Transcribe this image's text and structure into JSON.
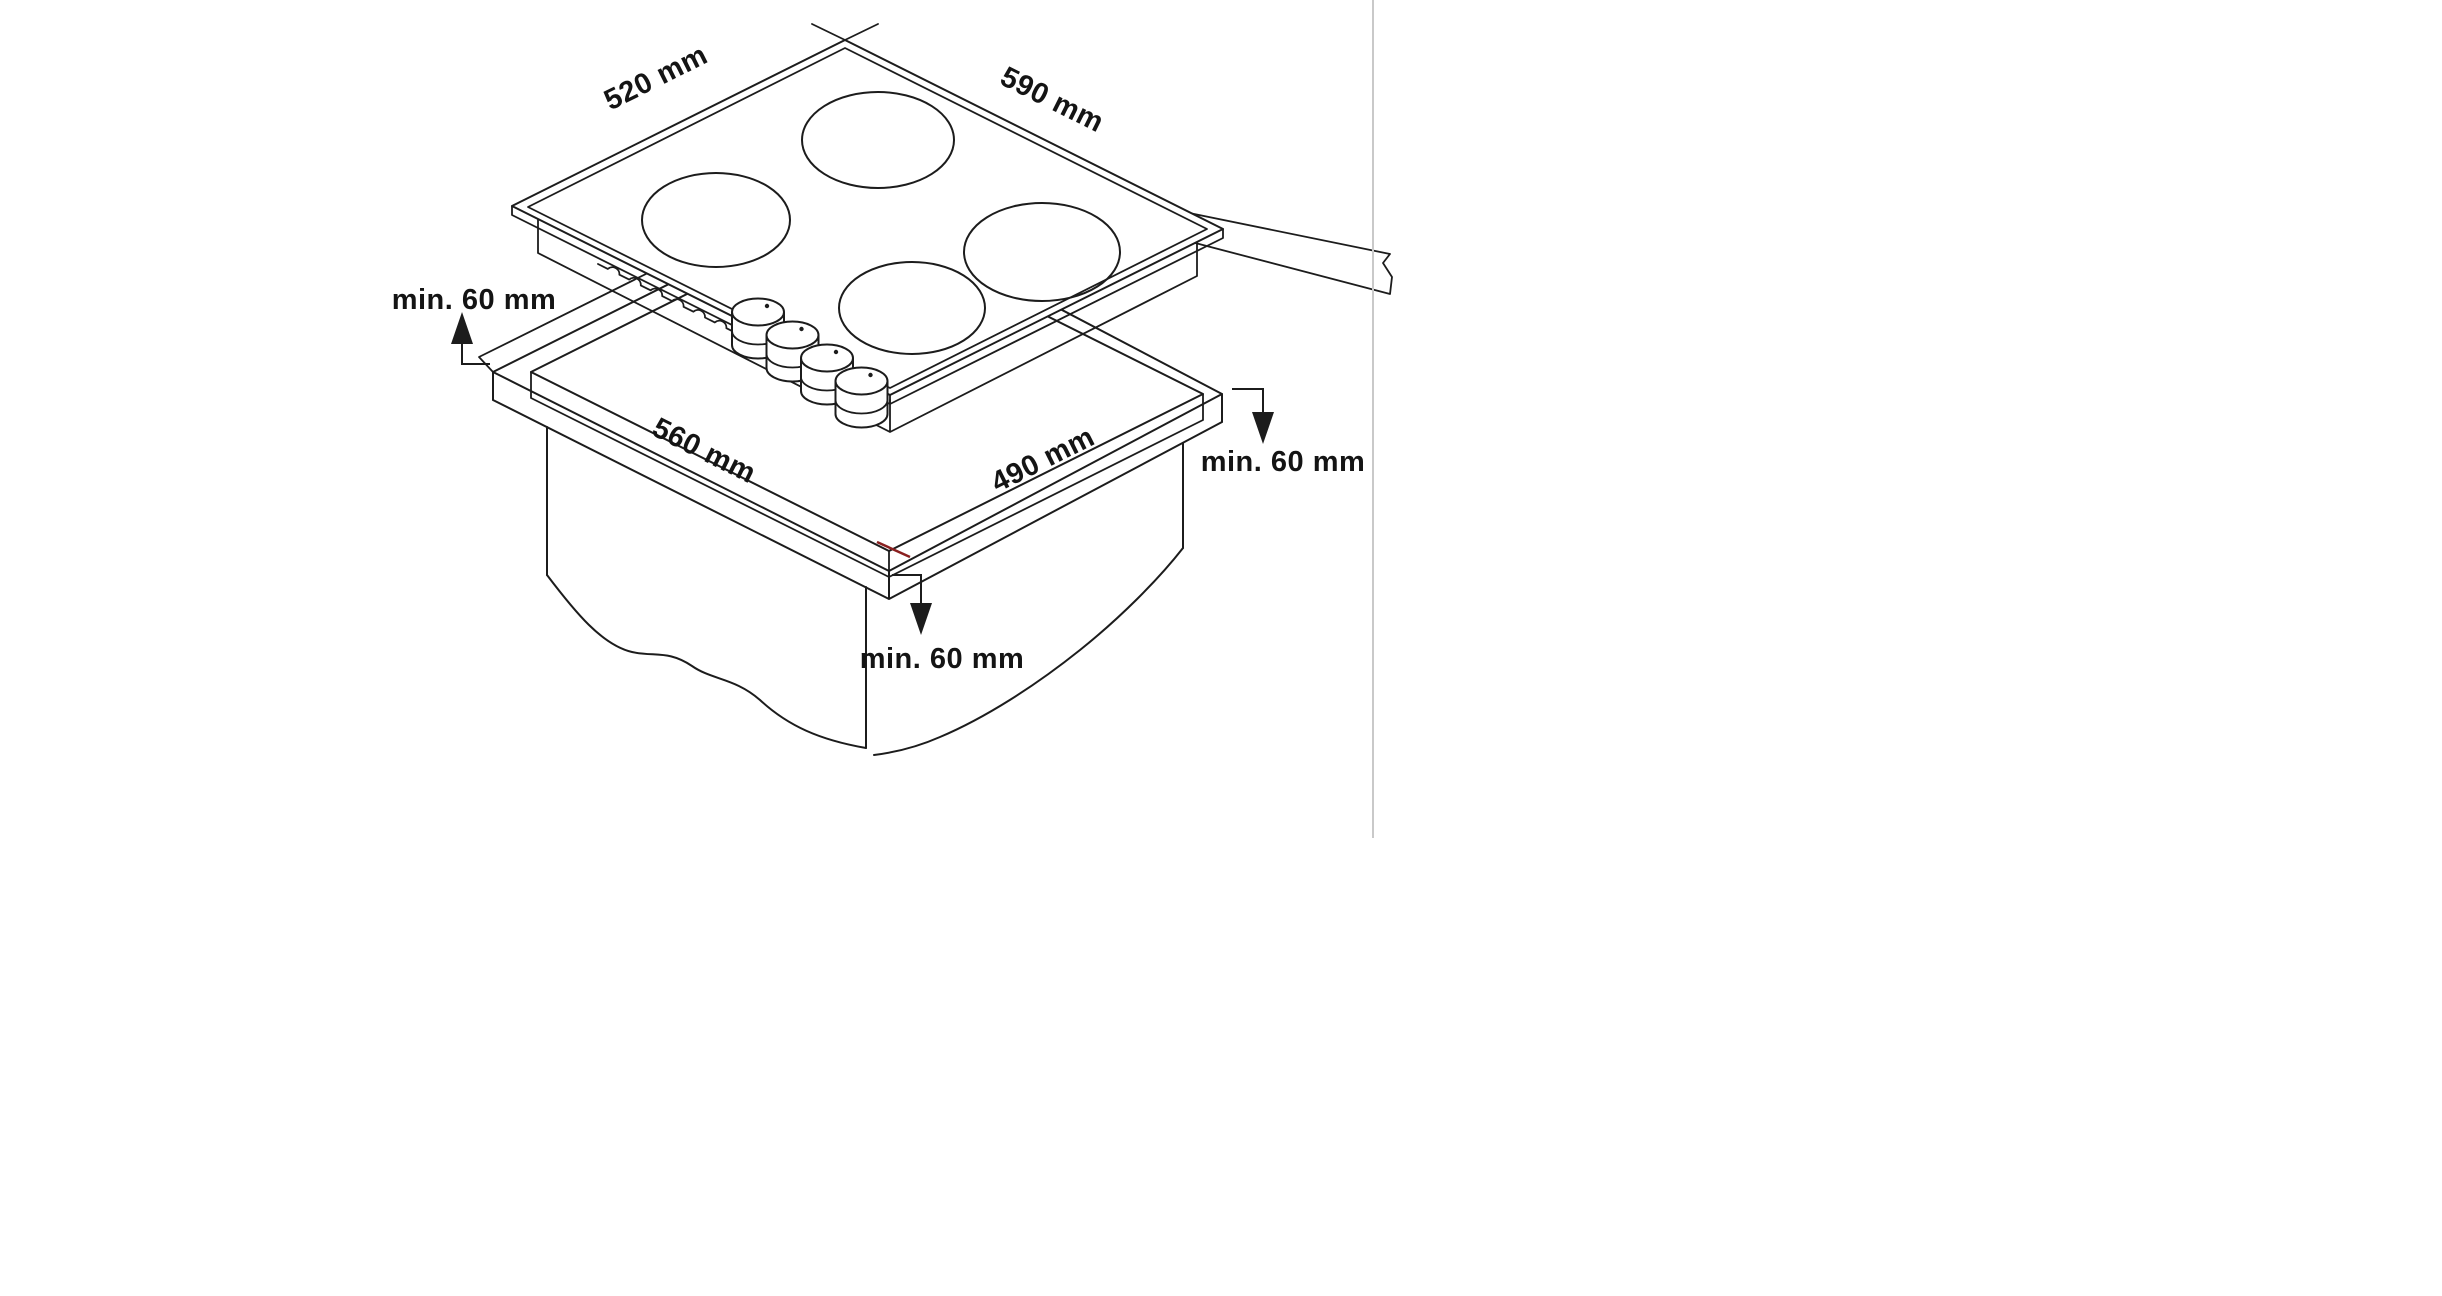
{
  "diagram": {
    "labels": {
      "hob_depth": "520 mm",
      "hob_width": "590 mm",
      "cutout_width": "560 mm",
      "cutout_depth": "490 mm",
      "clearance_left": "min. 60 mm",
      "clearance_right": "min. 60 mm",
      "clearance_front": "min. 60 mm"
    },
    "colors": {
      "line": "#1c1c1c",
      "text": "#141414",
      "divider": "#c9c9c9",
      "accent_tick": "#8a2020",
      "background": "#ffffff"
    }
  }
}
